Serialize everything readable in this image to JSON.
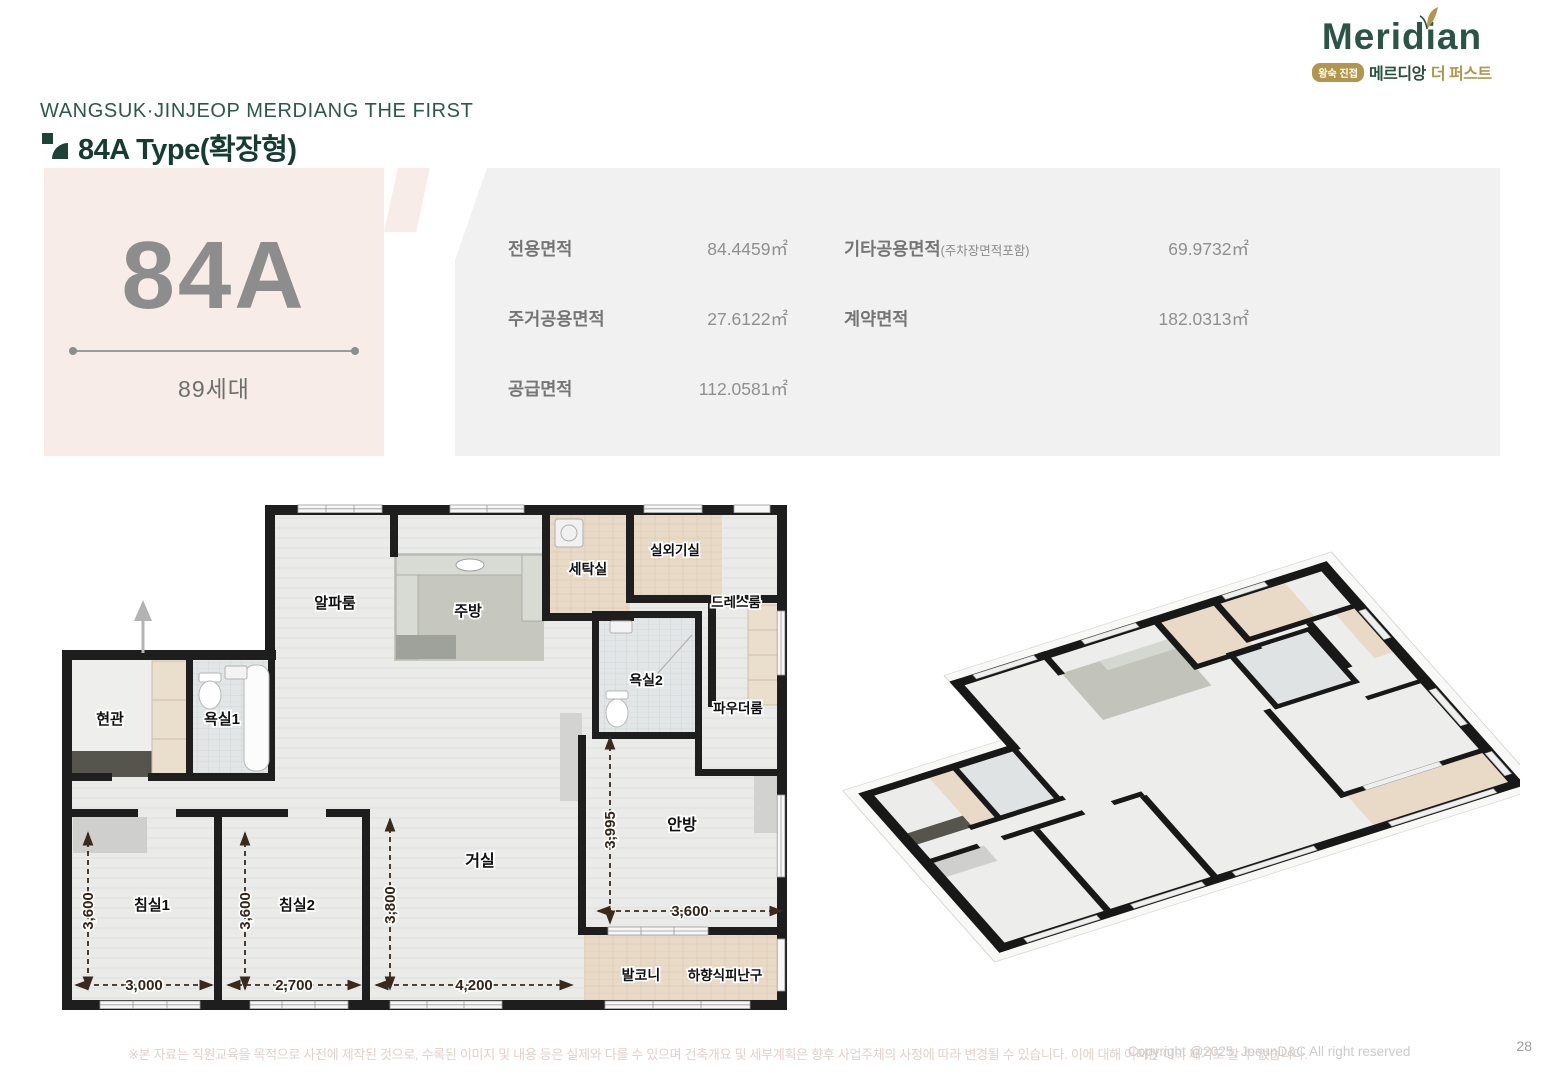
{
  "page": {
    "project_title": "WANGSUK·JINJEOP MERDIANG THE FIRST",
    "section_title": "84A Type(확장형)",
    "disclaimer": "※본 자료는 직원교육을 목적으로 사전에 제작된 것으로, 수록된 이미지 및 내용 등은 실제와 다를 수 있으며 건축개요 및 세부계획은 향후 사업주체의 사정에 따라 변경될 수 있습니다. 이에 대해 어떠한 이의 제기도 할 수 없습니다.",
    "copyright": "Copyright @2025, JoeunD&C All right reserved",
    "page_number": "28"
  },
  "logo": {
    "brand": "Meridian",
    "badge": "왕숙 진접",
    "brand_kr": "메르디앙",
    "suffix_kr": "더 퍼스트",
    "green": "#2a5446",
    "gold": "#b2964c"
  },
  "icons": {
    "leaf": "leaf-icon",
    "type_marker": "type-marker-icon",
    "entry_arrow": "entry-direction-arrow-icon"
  },
  "unit": {
    "type_code": "84A",
    "households": "89세대"
  },
  "areas": {
    "rows": [
      {
        "c1": {
          "label": "전용면적",
          "value": "84.4459㎡"
        },
        "c2": {
          "label": "기타공용면적",
          "note": "(주차장면적포함)",
          "value": "69.9732㎡"
        }
      },
      {
        "c1": {
          "label": "주거공용면적",
          "value": "27.6122㎡"
        },
        "c2": {
          "label": "계약면적",
          "note": "",
          "value": "182.0313㎡"
        }
      },
      {
        "c1": {
          "label": "공급면적",
          "value": "112.0581㎡"
        },
        "c2": {
          "label": "",
          "note": "",
          "value": ""
        }
      }
    ]
  },
  "floorplan": {
    "rooms": {
      "entrance": "현관",
      "bath1": "욕실1",
      "alpha": "알파룸",
      "kitchen": "주방",
      "laundry": "세탁실",
      "outdoor_unit": "실외기실",
      "dress": "드레스룸",
      "bath2": "욕실2",
      "powder": "파우더룸",
      "bed1": "침실1",
      "bed2": "침실2",
      "living": "거실",
      "master": "안방",
      "balcony": "발코니",
      "escape_hatch": "하향식피난구"
    },
    "dims": {
      "bed1_w": "3,000",
      "bed1_h": "3,600",
      "bed2_w": "2,700",
      "bed2_h": "3,600",
      "living_w": "4,200",
      "living_h": "3,800",
      "master_w": "3,600",
      "master_h": "3,995"
    },
    "colors": {
      "wall": "#1e1e1e",
      "floor": "#eaebe9",
      "tile_beige": "#e9dac7",
      "tile_bath": "#e3e6e7",
      "dimension": "#3a2a1e",
      "panel_beige": "#f7ece7",
      "panel_gray": "#f1f1f2"
    }
  }
}
